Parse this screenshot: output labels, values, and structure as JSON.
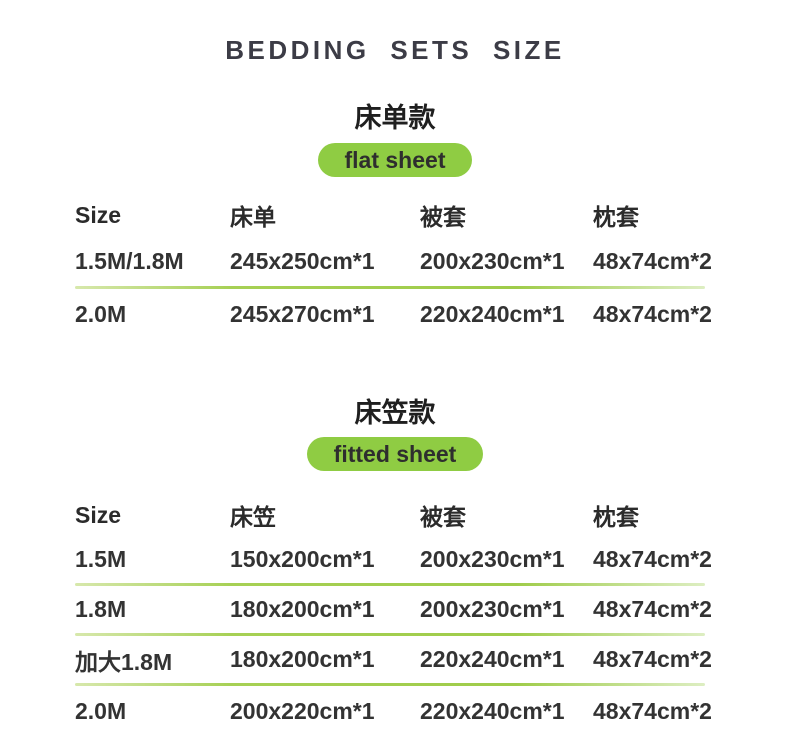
{
  "page": {
    "title": "BEDDING SETS SIZE"
  },
  "colors": {
    "badge_green": "#8fcc43",
    "divider_green": "#a6d054",
    "text_dark": "#333333",
    "title_color": "#3c3c46"
  },
  "sections": [
    {
      "heading_cn": "床单款",
      "badge_label": "flat sheet",
      "table": {
        "headers": [
          "Size",
          "床单",
          "被套",
          "枕套"
        ],
        "rows": [
          [
            "1.5M/1.8M",
            "245x250cm*1",
            "200x230cm*1",
            "48x74cm*2"
          ],
          [
            "2.0M",
            "245x270cm*1",
            "220x240cm*1",
            "48x74cm*2"
          ]
        ]
      }
    },
    {
      "heading_cn": "床笠款",
      "badge_label": "fitted sheet",
      "table": {
        "headers": [
          "Size",
          "床笠",
          "被套",
          "枕套"
        ],
        "rows": [
          [
            "1.5M",
            "150x200cm*1",
            "200x230cm*1",
            "48x74cm*2"
          ],
          [
            "1.8M",
            "180x200cm*1",
            "200x230cm*1",
            "48x74cm*2"
          ],
          [
            "加大1.8M",
            "180x200cm*1",
            "220x240cm*1",
            "48x74cm*2"
          ],
          [
            "2.0M",
            "200x220cm*1",
            "220x240cm*1",
            "48x74cm*2"
          ]
        ]
      }
    }
  ]
}
